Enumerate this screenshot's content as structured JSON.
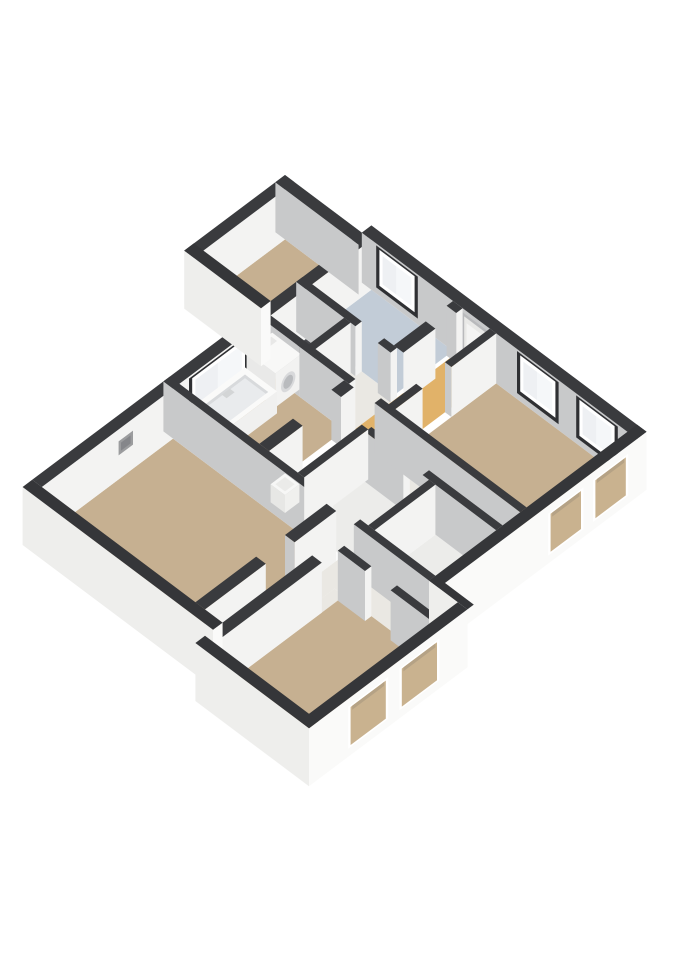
{
  "view": {
    "width": 679,
    "height": 960,
    "background": "#ffffff",
    "projection": {
      "ox": 285,
      "oy": 175,
      "ux": 0.8,
      "uy": 0.6,
      "wall_h": 50,
      "ground_z": -8
    }
  },
  "colors": {
    "top_int": "#3a3b3e",
    "top_ext": "#353639",
    "face_white": "#f3f3f2",
    "face_gray": "#c8c9ca",
    "ext_se": "#fafaf9",
    "ext_sw": "#eeeeec",
    "floor_tan": "#c6b091",
    "floor_blue": "#c2ccd7",
    "floor_orange": "#e1b269",
    "floor_hall": "#eae8e3",
    "floor_small": "#ececea",
    "floor_void": "#46474b",
    "glass": "#f5f7f9",
    "frame": "#ffffff",
    "reveal": "#2f3033",
    "opening_fill": "#c9b28f",
    "door_fill": "#e9e9e7",
    "door_inner": "#f4f4f3",
    "vent_outer": "#9b9c9e",
    "vent_inner": "#85868a",
    "tub_top": "#fafaf9",
    "tub_side_u": "#f0f0ef",
    "tub_side_v": "#e8e8e6",
    "tub_cavity": "#e9ebed",
    "tub_shade": "#d8dadc",
    "washer_top": "#f8f8f7",
    "washer_face": "#f2f2f1",
    "washer_side": "#e9e9e8",
    "washer_ring": "#d8d9db",
    "washer_door": "#b9bbbe"
  },
  "scene": {
    "floors": [
      {
        "name": "bedroom-top",
        "rect": [
          12,
          96,
          -114,
          -12
        ],
        "color": "floor_tan"
      },
      {
        "name": "stair-void",
        "rect": [
          108,
          156,
          -126,
          -82
        ],
        "color": "floor_void"
      },
      {
        "name": "hall-pocket",
        "rect": [
          164,
          218,
          -134,
          -74
        ],
        "color": "floor_hall"
      },
      {
        "name": "bathroom-blue",
        "rect": [
          108,
          210,
          -74,
          0
        ],
        "color": "floor_blue"
      },
      {
        "name": "hall-orange",
        "rect": [
          214,
          256,
          -126,
          0
        ],
        "color": "floor_orange"
      },
      {
        "name": "bedroom-right",
        "rect": [
          264,
          428,
          -126,
          0
        ],
        "color": "floor_tan"
      },
      {
        "name": "hall-strip",
        "rect": [
          264,
          428,
          -156,
          -134
        ],
        "color": "floor_hall"
      },
      {
        "name": "hall-center",
        "rect": [
          220,
          264,
          -240,
          -134
        ],
        "color": "floor_hall"
      },
      {
        "name": "bathroom-main",
        "rect": [
          108,
          208,
          -232,
          -134
        ],
        "color": "floor_tan"
      },
      {
        "name": "toilet",
        "rect": [
          264,
          344,
          -240,
          -164
        ],
        "color": "floor_small"
      },
      {
        "name": "storage",
        "rect": [
          352,
          428,
          -240,
          -164
        ],
        "color": "floor_small"
      },
      {
        "name": "living-room",
        "rect": [
          108,
          300,
          -412,
          -248
        ],
        "color": "floor_tan"
      },
      {
        "name": "corridor-west",
        "rect": [
          312,
          334,
          -412,
          -248
        ],
        "color": "floor_hall"
      },
      {
        "name": "hall-south",
        "rect": [
          312,
          464,
          -272,
          -240
        ],
        "color": "floor_hall"
      },
      {
        "name": "door-patch",
        "rect": [
          334,
          346,
          -300,
          -272
        ],
        "color": "floor_hall"
      },
      {
        "name": "bedroom-bottom",
        "rect": [
          346,
          464,
          -434,
          -272
        ],
        "color": "floor_tan"
      }
    ],
    "far_walls": [
      {
        "name": "wall-toproom-se",
        "dir": "v",
        "band": [
          96,
          108
        ],
        "segs": [
          {
            "r": [
              -126,
              0
            ],
            "cap": true
          }
        ],
        "windows": []
      },
      {
        "name": "wall-nw-exterior",
        "dir": "v",
        "band": [
          96,
          108
        ],
        "segs": [
          {
            "r": [
              -248,
              -126
            ],
            "cap": false
          },
          {
            "r": [
              -412,
              -248
            ],
            "cap": false
          }
        ],
        "windows": [
          {
            "kind": "glass",
            "span": [
              -224,
              -158
            ],
            "z": [
              10,
              46
            ],
            "reveal": true
          },
          {
            "kind": "vent",
            "span": [
              -316,
              -298
            ],
            "z": [
              24,
              38
            ],
            "reveal": false
          }
        ]
      },
      {
        "name": "wall-toproom-nw",
        "dir": "v",
        "band": [
          0,
          12
        ],
        "segs": [
          {
            "r": [
              -126,
              0
            ],
            "cap": false
          }
        ],
        "windows": []
      },
      {
        "name": "wall-toproom-ne",
        "dir": "u",
        "band": [
          -12,
          0
        ],
        "segs": [
          {
            "r": [
              0,
              104
            ],
            "cap": false
          }
        ],
        "windows": []
      },
      {
        "name": "wall-ne-exterior",
        "dir": "u",
        "band": [
          0,
          12
        ],
        "segs": [
          {
            "r": [
              96,
              440
            ],
            "cap": false
          }
        ],
        "windows": [
          {
            "kind": "glass",
            "span": [
              118,
              162
            ],
            "z": [
              10,
              46
            ],
            "reveal": true
          },
          {
            "kind": "door",
            "span": [
              224,
              252
            ],
            "z": [
              0,
              46
            ],
            "reveal": false
          },
          {
            "kind": "glass",
            "span": [
              294,
              338
            ],
            "z": [
              10,
              46
            ],
            "reveal": true
          },
          {
            "kind": "glass",
            "span": [
              368,
              412
            ],
            "z": [
              10,
              46
            ],
            "reveal": true
          }
        ]
      }
    ],
    "int_walls": [
      {
        "name": "wall-bath-north",
        "dir": "u",
        "band": [
          -134,
          -126
        ],
        "segs": [
          {
            "r": [
              108,
              152
            ],
            "cap": false
          },
          {
            "r": [
              152,
              214
            ],
            "cap": true
          },
          {
            "r": [
              246,
              428
            ],
            "cap": false
          }
        ]
      },
      {
        "name": "wall-void-blue",
        "dir": "u",
        "band": [
          -82,
          -74
        ],
        "segs": [
          {
            "r": [
              96,
              170
            ],
            "cap": true
          },
          {
            "r": [
              198,
              214
            ],
            "cap": true
          }
        ]
      },
      {
        "name": "wall-void-se",
        "dir": "v",
        "band": [
          156,
          164
        ],
        "segs": [
          {
            "r": [
              -126,
              -82
            ],
            "cap": false
          }
        ]
      },
      {
        "name": "wall-blue-se",
        "dir": "v",
        "band": [
          210,
          222
        ],
        "segs": [
          {
            "r": [
              -74,
              -34
            ],
            "cap": false
          },
          {
            "r": [
              -8,
              0
            ],
            "cap": true
          }
        ]
      },
      {
        "name": "wall-bedroomright-nw",
        "dir": "v",
        "band": [
          256,
          264
        ],
        "segs": [
          {
            "r": [
              -240,
              -160
            ],
            "cap": false
          },
          {
            "r": [
              -128,
              -92
            ],
            "cap": true
          },
          {
            "r": [
              -56,
              0
            ],
            "cap": true
          }
        ]
      },
      {
        "name": "wall-bath-se",
        "dir": "v",
        "band": [
          208,
          220
        ],
        "segs": [
          {
            "r": [
              -240,
              -198
            ],
            "cap": false
          },
          {
            "r": [
              -150,
              -134
            ],
            "cap": true
          }
        ]
      },
      {
        "name": "wall-hallstrip",
        "dir": "u",
        "band": [
          -164,
          -156
        ],
        "segs": [
          {
            "r": [
              264,
              312
            ],
            "cap": true
          },
          {
            "r": [
              336,
              428
            ],
            "cap": false
          }
        ]
      },
      {
        "name": "wall-toilet-storage",
        "dir": "v",
        "band": [
          344,
          352
        ],
        "segs": [
          {
            "r": [
              -240,
              -164
            ],
            "cap": false
          }
        ]
      },
      {
        "name": "wall-living-ne",
        "dir": "u",
        "band": [
          -248,
          -240
        ],
        "segs": [
          {
            "r": [
              96,
              300
            ],
            "cap": true
          },
          {
            "r": [
              334,
              428
            ],
            "cap": false
          }
        ]
      },
      {
        "name": "wall-living-se",
        "dir": "v",
        "band": [
          300,
          312
        ],
        "segs": [
          {
            "r": [
              -412,
              -336
            ],
            "cap": false
          },
          {
            "r": [
              -300,
              -248
            ],
            "cap": true
          }
        ]
      },
      {
        "name": "wall-bedroombottom-nw",
        "dir": "v",
        "band": [
          334,
          346
        ],
        "segs": [
          {
            "r": [
              -434,
              -300
            ],
            "cap": false
          }
        ]
      },
      {
        "name": "wall-bedroombottom-ne",
        "dir": "u",
        "band": [
          -280,
          -272
        ],
        "segs": [
          {
            "r": [
              346,
              380
            ],
            "cap": true
          },
          {
            "r": [
              412,
              464
            ],
            "cap": false
          }
        ]
      }
    ],
    "near_walls": [
      {
        "name": "wall-toproom-sw",
        "dir": "u",
        "band": [
          -126,
          -114
        ],
        "segs": [
          {
            "r": [
              0,
              96
            ],
            "cap": true
          }
        ],
        "windows": []
      },
      {
        "name": "wall-se-main",
        "dir": "v",
        "band": [
          428,
          440
        ],
        "segs": [
          {
            "r": [
              -248,
              12
            ],
            "cap": false
          }
        ],
        "windows": [
          {
            "kind": "opening",
            "span": [
              -108,
              -70
            ],
            "z": [
              2,
              40
            ]
          },
          {
            "kind": "opening",
            "span": [
              -52,
              -14
            ],
            "z": [
              2,
              40
            ]
          }
        ]
      },
      {
        "name": "wall-se-step",
        "dir": "u",
        "band": [
          -248,
          -240
        ],
        "segs": [
          {
            "r": [
              428,
              476
            ],
            "cap": false
          }
        ],
        "windows": []
      },
      {
        "name": "wall-se-bottom",
        "dir": "v",
        "band": [
          464,
          476
        ],
        "segs": [
          {
            "r": [
              -446,
              -248
            ],
            "cap": false
          }
        ],
        "windows": [
          {
            "kind": "opening",
            "span": [
              -394,
              -350
            ],
            "z": [
              2,
              40
            ]
          },
          {
            "kind": "opening",
            "span": [
              -330,
              -286
            ],
            "z": [
              2,
              40
            ]
          }
        ]
      },
      {
        "name": "wall-sw-left",
        "dir": "u",
        "band": [
          -424,
          -412
        ],
        "segs": [
          {
            "r": [
              96,
              334
            ],
            "cap": true
          }
        ],
        "windows": []
      },
      {
        "name": "wall-sw-bottom",
        "dir": "u",
        "band": [
          -446,
          -434
        ],
        "segs": [
          {
            "r": [
              334,
              476
            ],
            "cap": false
          }
        ],
        "windows": []
      }
    ],
    "fixtures": [
      {
        "type": "bathtub",
        "name": "bathtub",
        "rect": [
          112,
          152,
          -230,
          -162
        ],
        "h": 22
      },
      {
        "type": "washer",
        "name": "washing-machine",
        "rect": [
          110,
          146,
          -158,
          -126
        ],
        "h": 34
      },
      {
        "type": "boiler",
        "name": "boiler-unit",
        "rect": [
          222,
          240,
          -240,
          -222
        ],
        "h": 18
      }
    ]
  }
}
